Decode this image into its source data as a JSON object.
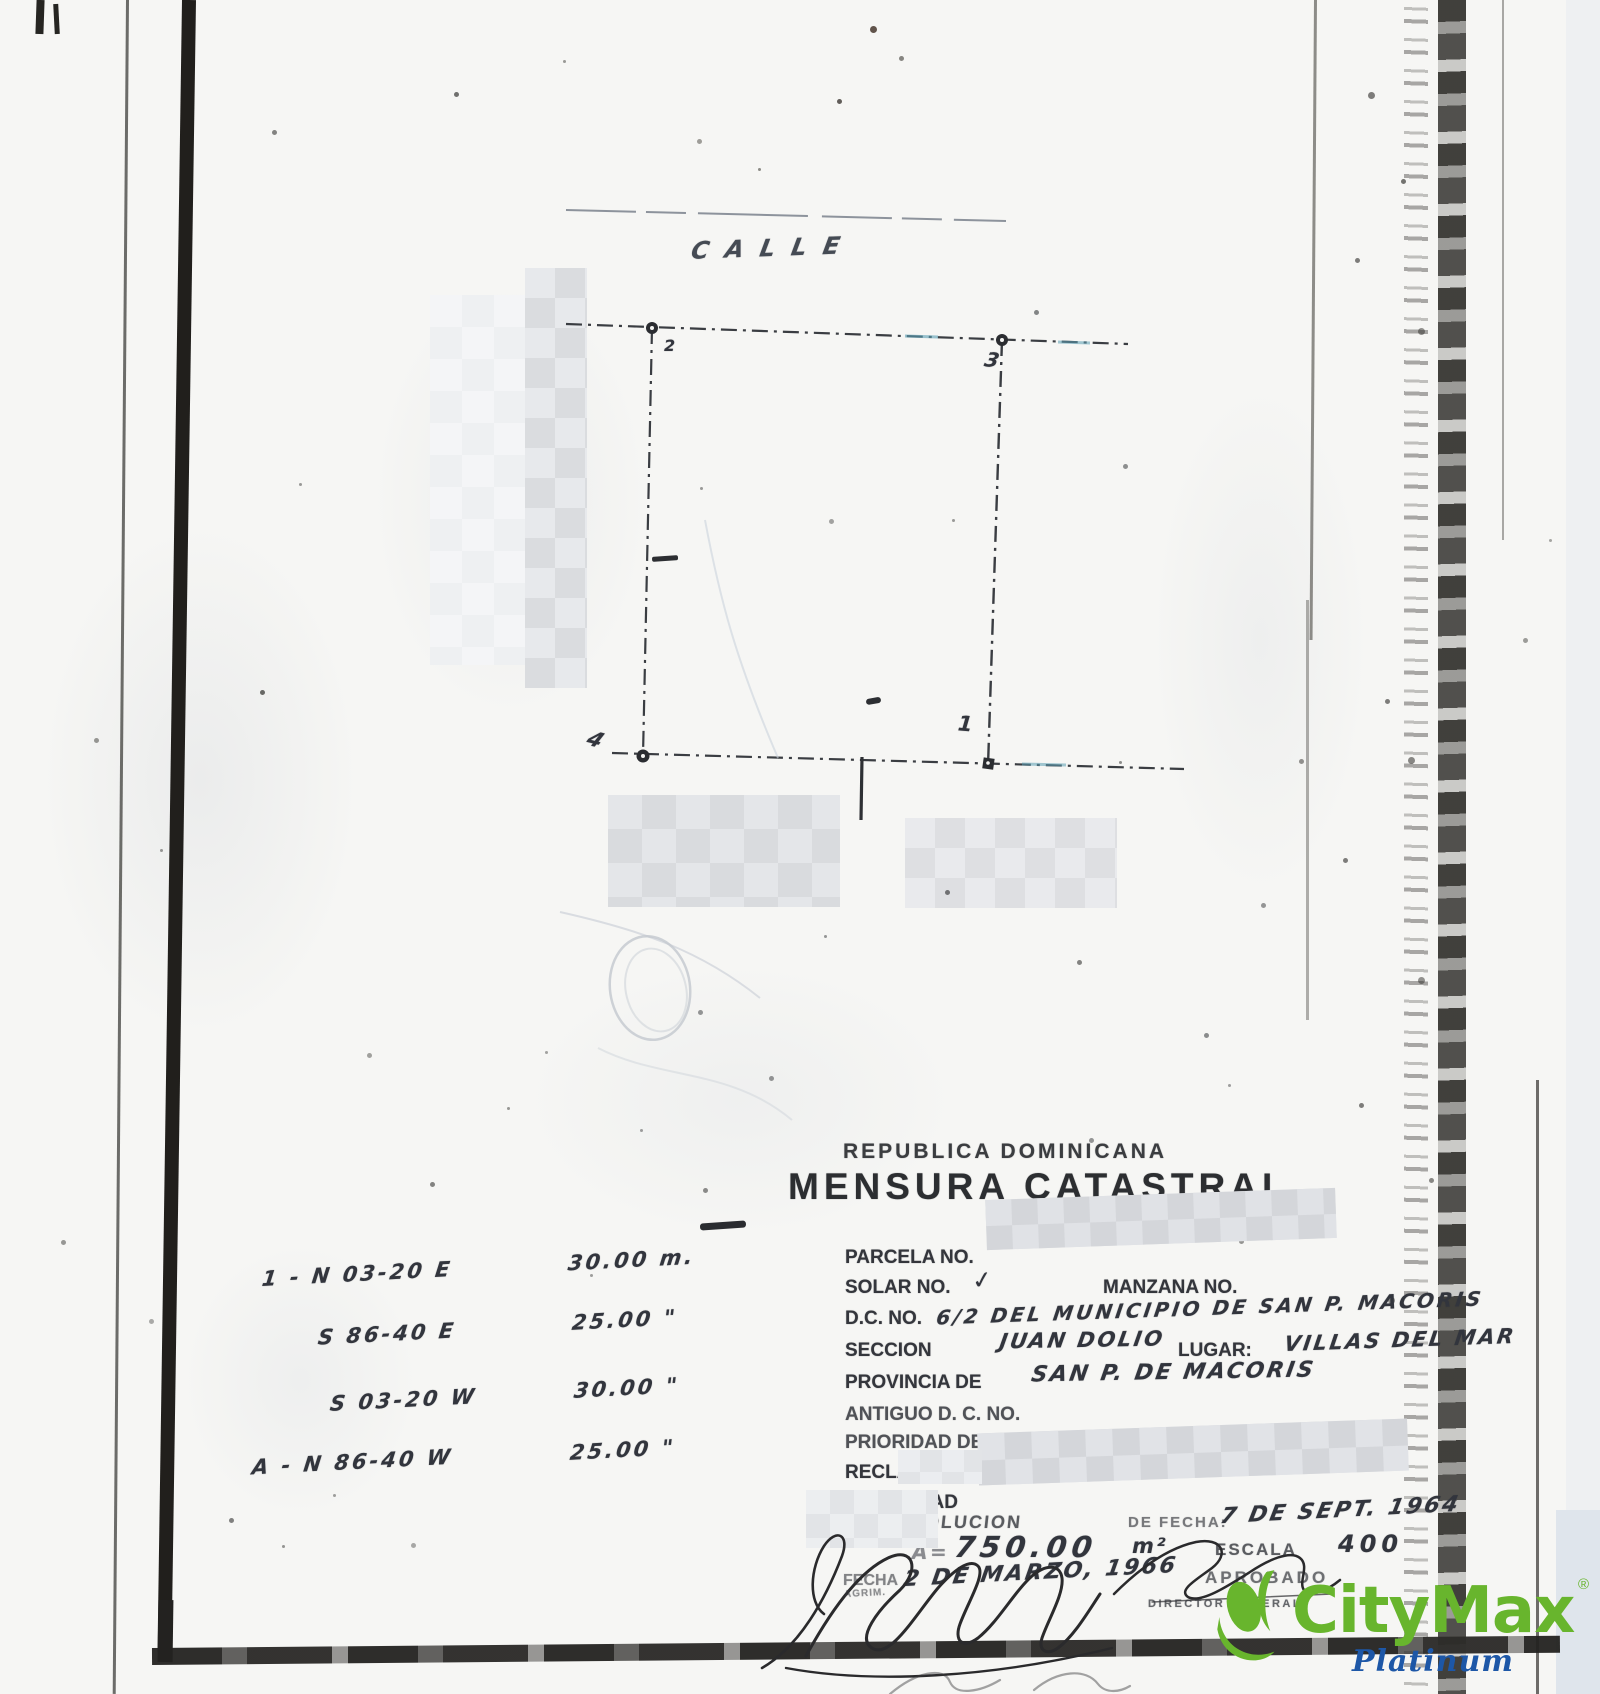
{
  "document": {
    "country_header": "REPUBLICA  DOMINICANA",
    "title": "MENSURA  CATASTRAL"
  },
  "plan": {
    "street_label": "CALLE",
    "corner_top_left": "2",
    "corner_top_right": "3",
    "corner_bottom_right": "1",
    "corner_bottom_left": "4"
  },
  "bearings": [
    {
      "b": "1 - N 03-20 E",
      "d": "30.00 m."
    },
    {
      "b": "S 86-40 E",
      "d": "25.00 \""
    },
    {
      "b": "S 03-20 W",
      "d": "30.00 \""
    },
    {
      "b": "A - N 86-40 W",
      "d": "25.00 \""
    }
  ],
  "form": {
    "parcela_label": "PARCELA NO.",
    "solar_label": "SOLAR NO.",
    "solar_value": "✓",
    "manzana_label": "MANZANA NO.",
    "dc_label": "D.C. NO.",
    "dc_value": "6/2 DEL MUNICIPIO DE SAN P. MACORIS",
    "seccion_label": "SECCION",
    "seccion_value": "JUAN DOLIO",
    "lugar_label": "LUGAR:",
    "lugar_value": "VILLAS DEL MAR",
    "provincia_label": "PROVINCIA DE",
    "provincia_value": "SAN P. DE MACORIS",
    "antiguo_label": "ANTIGUO D. C. NO.",
    "prioridad_label": "PRIORIDAD DE FECHA:",
    "reclamante_label": "RECLAMANTE:",
    "propiedad_label": "PROPIEDAD"
  },
  "resolution": {
    "resolucion_label": "RESOLUCION",
    "de_fecha_label": "DE FECHA:",
    "resolucion_date": "7 DE SEPT. 1964",
    "area_prefix": "A=",
    "area_value": "750.00",
    "area_unit": "m²",
    "escala_label": "ESCALA",
    "escala_value": "400",
    "fecha_label": "FECHA",
    "fecha_value": "2 DE MARZO, 1966",
    "aprobado_label": "APROBADO"
  },
  "signatures": {
    "left_caption": "AGRIM.",
    "right_caption": "DIRECTOR GENERAL"
  },
  "watermark": {
    "brand": "CityMax",
    "registered": "®",
    "tier": "Platinum"
  },
  "colors": {
    "brand_green": "#68b52d",
    "platinum_blue": "#1d57a7",
    "ink": "#2e3036",
    "paper": "#f6f6f4"
  }
}
